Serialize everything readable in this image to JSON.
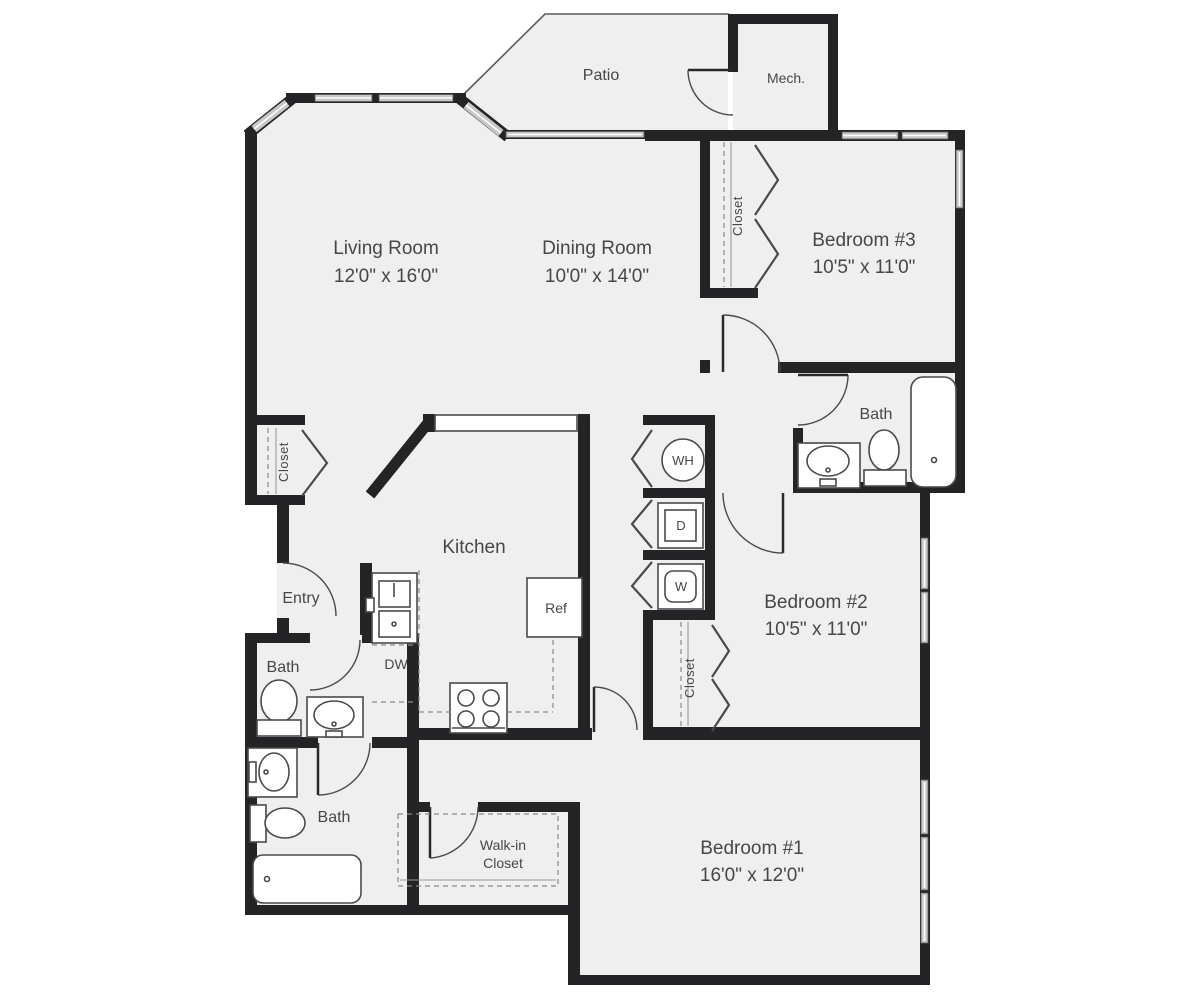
{
  "plan": {
    "title": "3-bedroom apartment floor plan",
    "patio": "Patio",
    "mech": "Mech.",
    "living": {
      "name": "Living Room",
      "dims": "12'0\" x 16'0\""
    },
    "dining": {
      "name": "Dining Room",
      "dims": "10'0\" x 14'0\""
    },
    "bedroom3": {
      "name": "Bedroom #3",
      "dims": "10'5\" x 11'0\""
    },
    "bedroom2": {
      "name": "Bedroom #2",
      "dims": "10'5\" x 11'0\""
    },
    "bedroom1": {
      "name": "Bedroom #1",
      "dims": "16'0\" x 12'0\""
    },
    "kitchen": "Kitchen",
    "entry": "Entry",
    "bath": "Bath",
    "closet": "Closet",
    "walkin_line1": "Walk-in",
    "walkin_line2": "Closet",
    "wh": "WH",
    "dryer": "D",
    "washer": "W",
    "ref": "Ref",
    "dw": "DW"
  },
  "colors": {
    "wall": "#242426",
    "floor": "#efeff0",
    "window": "#c7c7ca",
    "label": "#47474a",
    "background": "#ffffff"
  }
}
